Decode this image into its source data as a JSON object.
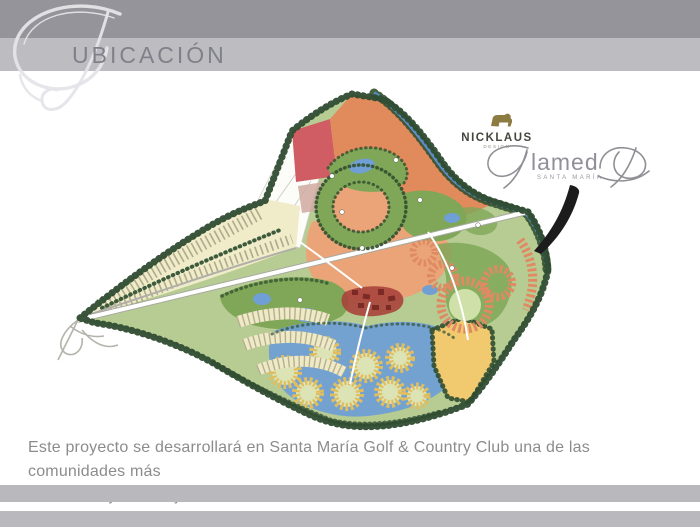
{
  "header": {
    "title": "UBICACIÓN"
  },
  "map": {
    "nicklaus_logo": {
      "name": "NICKLAUS",
      "tagline": "DESIGN"
    },
    "alameda_logo": {
      "brand": "Alameda",
      "middle_text": "lamed",
      "subtitle": "SANTA MARÍA"
    },
    "palette": {
      "rough_green": "#b7cc93",
      "fairway_green": "#7fa757",
      "trees_dark": "#2f4c31",
      "water_blue": "#6f9fd4",
      "stream_blue": "#5b8fc9",
      "parcel_orange": "#e18b5c",
      "parcel_salmon": "#eba478",
      "parcel_red": "#cf5d63",
      "parcel_tan": "#cfa9a0",
      "parcel_yellow": "#f1ca70",
      "lots_cream": "#f0ebc8",
      "town_red": "#a8443c",
      "cluster_gold": "#e0bd5e",
      "ring_salmon": "#df8a62",
      "road_white": "#ffffff",
      "arrow_black": "#1c1c1c"
    }
  },
  "body": {
    "line1": "Este proyecto se desarrollará en Santa María Golf & Country Club una de las comunidades más",
    "line2": "exclusivas y con mejor ubicación de la Ciudad de Panamá."
  }
}
